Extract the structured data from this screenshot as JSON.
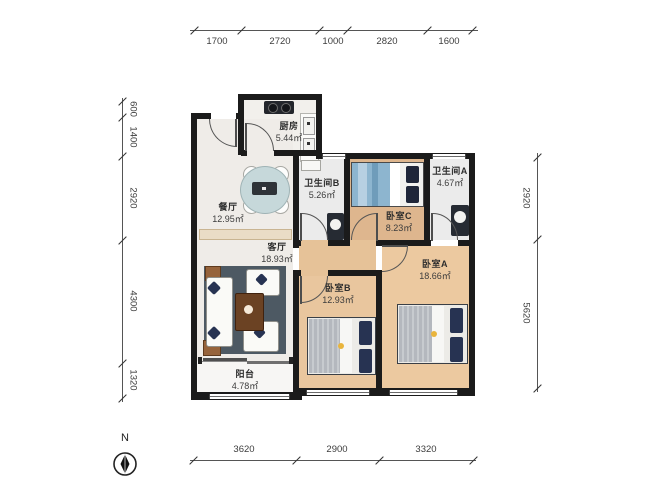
{
  "rooms": {
    "kitchen": {
      "name": "厨房",
      "area": "5.44㎡"
    },
    "bath_b": {
      "name": "卫生间B",
      "area": "5.26㎡"
    },
    "bath_a": {
      "name": "卫生间A",
      "area": "4.67㎡"
    },
    "dining": {
      "name": "餐厅",
      "area": "12.95㎡"
    },
    "living": {
      "name": "客厅",
      "area": "18.93㎡"
    },
    "bed_c": {
      "name": "卧室C",
      "area": "8.23㎡"
    },
    "bed_a": {
      "name": "卧室A",
      "area": "18.66㎡"
    },
    "bed_b": {
      "name": "卧室B",
      "area": "12.93㎡"
    },
    "balcony": {
      "name": "阳台",
      "area": "4.78㎡"
    }
  },
  "dimensions": {
    "top": [
      "1700",
      "2720",
      "1000",
      "2820",
      "1600"
    ],
    "left": [
      "600",
      "1400",
      "2920",
      "4300",
      "1320"
    ],
    "right": [
      "2920",
      "5620"
    ],
    "bottom": [
      "3620",
      "2900",
      "3320"
    ]
  },
  "compass": {
    "north_label": "N"
  },
  "colors": {
    "wall": "#1b1b1b",
    "wood_floor": "#e9c69e",
    "wood_floor_dark": "#deb68e",
    "tile_floor": "#efece8",
    "bath_floor": "#ebebeb",
    "rug": "#4d5963",
    "bed_blue": "#8db5cf",
    "pillow_navy": "#273352",
    "lamp_yellow": "#e9b53d",
    "table_blue": "#c6d8da"
  }
}
